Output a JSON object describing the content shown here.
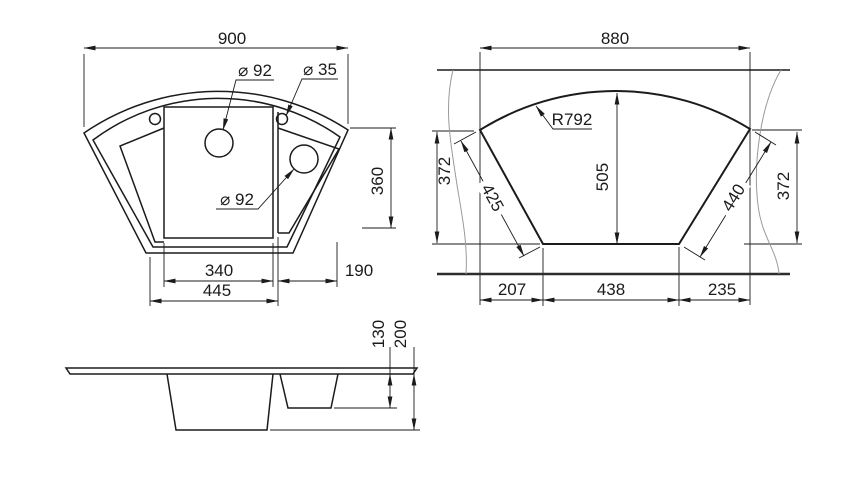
{
  "drawing": {
    "background": "#ffffff",
    "line_color": "#1b1b1b",
    "top_view": {
      "overall_width": "900",
      "main_drain_diameter": "⌀ 92",
      "tap_hole_diameter": "⌀ 35",
      "small_bowl_drain_diameter": "⌀ 92",
      "right_depth": "360",
      "main_bowl_width": "340",
      "right_wing_width": "190",
      "base_width": "445"
    },
    "cutout_view": {
      "cutout_width": "880",
      "arc_radius": "R792",
      "left_height": "372",
      "left_edge_length": "425",
      "center_height": "505",
      "right_edge_length": "440",
      "right_height": "372",
      "bottom_left_offset": "207",
      "bottom_width": "438",
      "bottom_right_offset": "235"
    },
    "side_view": {
      "small_bowl_depth": "130",
      "large_bowl_depth": "200"
    }
  }
}
